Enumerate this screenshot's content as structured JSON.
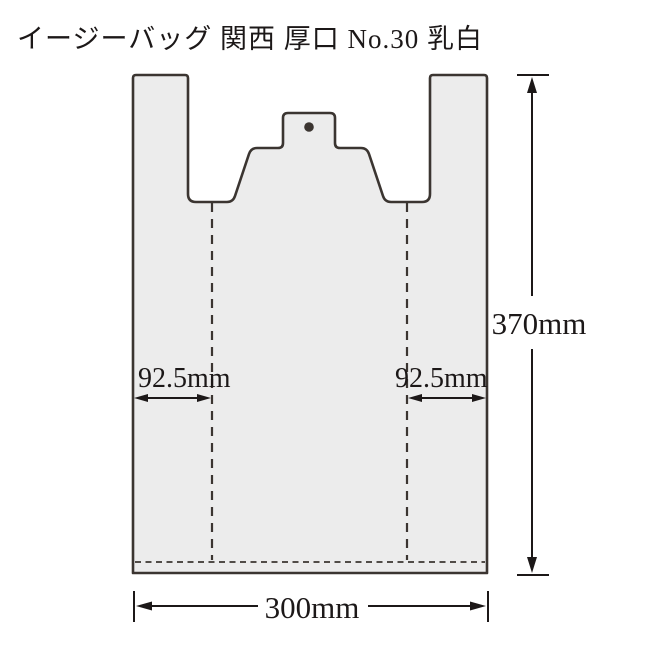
{
  "title": "イージーバッグ 関西 厚口 No.30 乳白",
  "colors": {
    "outline": "#3b3531",
    "bagFill": "#ececec",
    "ink": "#1c1818"
  },
  "diagram": {
    "hang_hole_icon": "filled-circle",
    "dimensions": {
      "height": "370mm",
      "width": "300mm",
      "gusset_left": "92.5mm",
      "gusset_right": "92.5mm"
    }
  }
}
